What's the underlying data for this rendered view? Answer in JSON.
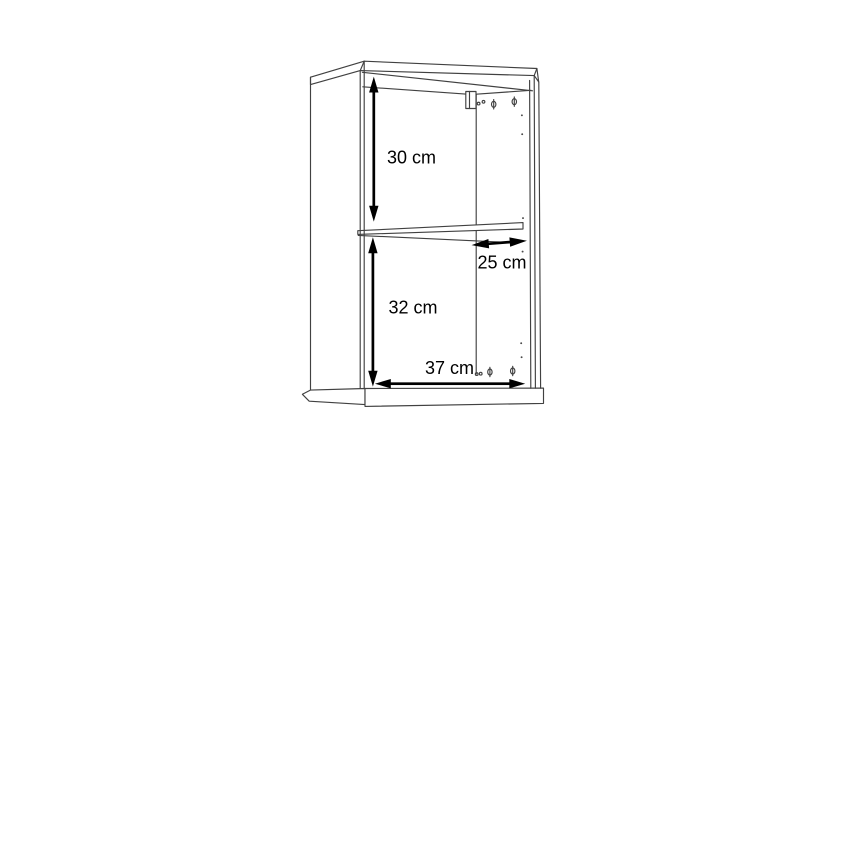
{
  "diagram": {
    "type": "furniture-dimension-drawing",
    "background_color": "#ffffff",
    "line_color": "#414141",
    "annotation_color": "#000000",
    "labels": {
      "upper_height": "30 cm",
      "shelf_depth": "25 cm",
      "lower_height": "32 cm",
      "width": "37 cm"
    },
    "dimensions_cm": {
      "upper_section_height": 30,
      "shelf_depth": 25,
      "lower_section_height": 32,
      "width": 37
    }
  }
}
